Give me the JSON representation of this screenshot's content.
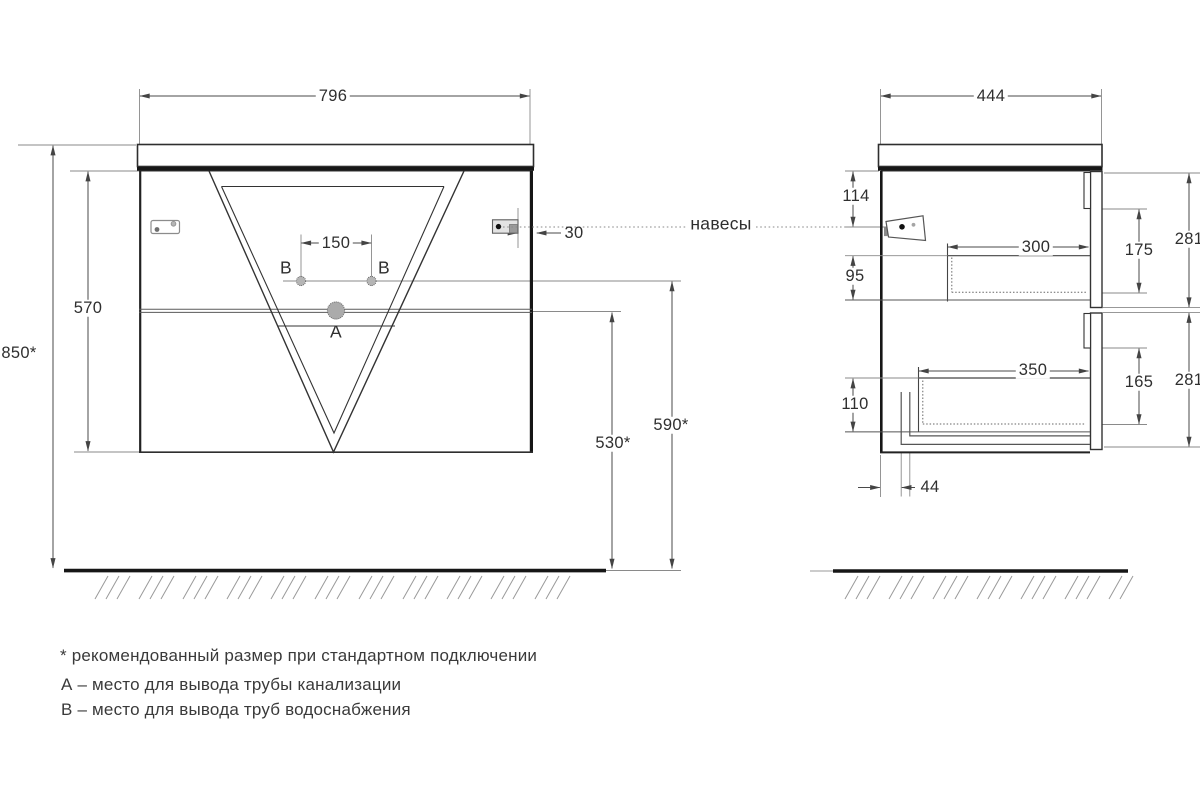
{
  "front_view": {
    "dim_width": "796",
    "dim_total_height": "850*",
    "dim_cabinet_height": "570",
    "dim_hole_spacing": "150",
    "dim_hinge_offset": "30",
    "dim_drain_to_floor": "530*",
    "dim_supply_to_floor": "590*",
    "label_b_left": "B",
    "label_b_right": "B",
    "label_a": "A"
  },
  "side_view": {
    "dim_depth": "444",
    "dim_top_to_hinge": "114",
    "dim_hinge_to_drawer": "95",
    "dim_bottom_zone": "110",
    "dim_upper_drawer_depth": "300",
    "dim_lower_drawer_depth": "350",
    "dim_upper_drawer_height": "175",
    "dim_lower_drawer_height": "165",
    "dim_upper_front_height": "281",
    "dim_lower_front_height": "281",
    "dim_back_gap": "44"
  },
  "callout": {
    "hangers": "навесы"
  },
  "footnotes": [
    "* рекомендованный размер при стандартном подключении",
    "А – место для вывода трубы канализации",
    "В – место для вывода труб водоснабжения"
  ],
  "colors": {
    "line": "#333333",
    "thick": "#161616",
    "dim": "#4a4a4a",
    "muted": "#8a8a8a"
  }
}
